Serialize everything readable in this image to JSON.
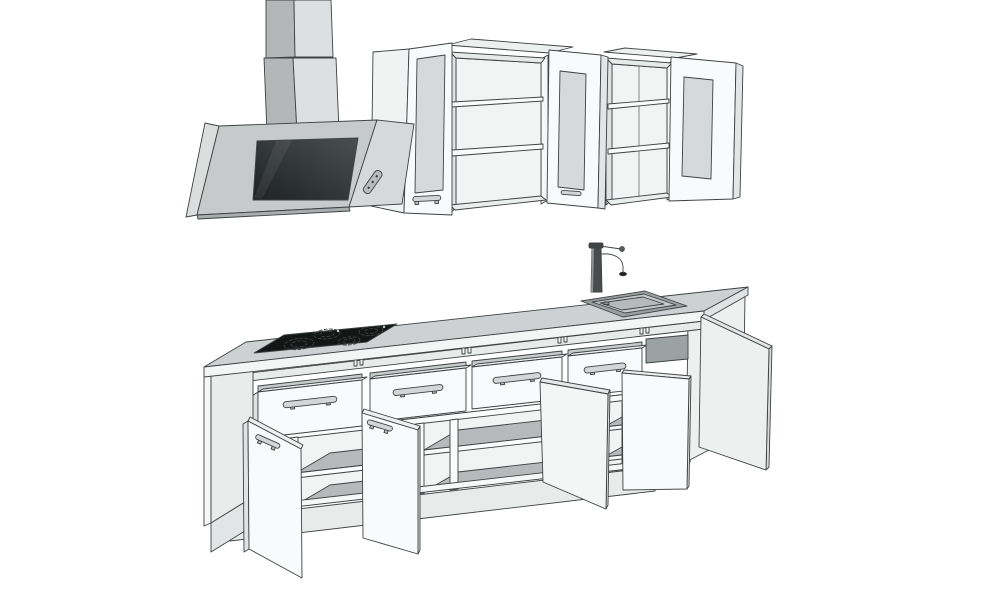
{
  "meta": {
    "description": "Monochrome 3D sketch-style rendering of a kitchen set: two wall cabinets with open frosted-glass doors, an angled extractor hood with two-segment chimney duct, and a base cabinet run with a four-burner cooktop, inset sink with tall mixer tap, four drawers and five open doors",
    "background": "#ffffff"
  },
  "colors": {
    "line": "#3f4242",
    "white_face": "#f9fafb",
    "light_face": "#eef0f0",
    "side_face": "#eaecec",
    "edge_face": "#e0e3e3",
    "interior_back": "#f2f4f4",
    "shelf_top": "#b7baba",
    "counter_top": "#cdd1d1",
    "counter_edge": "#f4f6f6",
    "chimney_left": "#b3b7b7",
    "chimney_right": "#dde0e0",
    "hood_frame": "#c6caca",
    "hood_side": "#d6d9d9",
    "hood_bottom": "#a9adad",
    "hood_glass_dark": "#1e2222",
    "hood_glass_light": "#4a4f4f",
    "cooktop_black": "#141616",
    "burner_ring": "#e8e8e8",
    "frosted_glass": "#d6d9d9",
    "sink_rim": "#9aa0a0",
    "sink_basin": "#c6caca",
    "sink_bottom": "#b6baba",
    "faucet_dark": "#474c4c",
    "recess_dark": "#9ca2a2",
    "handle_fill": "#d2d6d6",
    "plinth": "#e9ebeb"
  },
  "scene": {
    "wall_cabinets": {
      "count": 2,
      "open_glass_doors": 3,
      "shelves_visible": 4
    },
    "hood": {
      "type": "angled",
      "chimney_segments": 2,
      "control_buttons": 3
    },
    "island": {
      "drawers": 4,
      "open_doors": 5,
      "cooktop_burners": 4,
      "sink_bowls": 1,
      "faucets": 1
    }
  }
}
